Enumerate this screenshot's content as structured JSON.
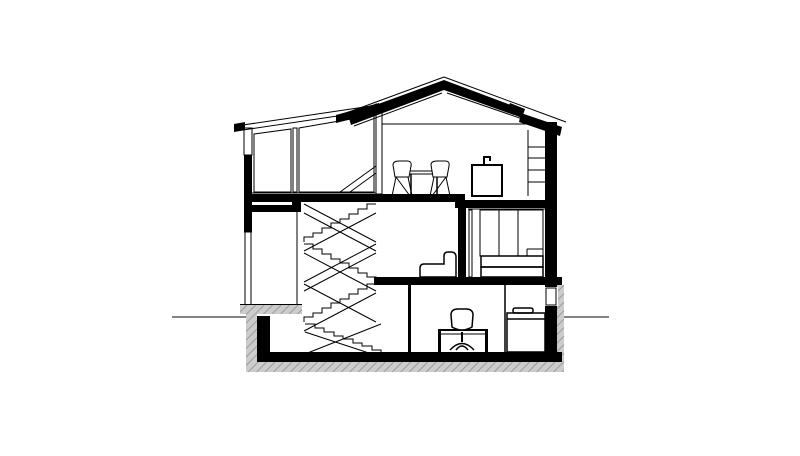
{
  "meta": {
    "width": 800,
    "height": 456,
    "drawing_kind": "architectural cross-section of a three-level gabled house"
  },
  "colors": {
    "background": "#ffffff",
    "ink": "#000000",
    "hatch_fill": "#cccccc",
    "hatch_line": "#8f8f8f",
    "ground_line": "#5a5a5a"
  },
  "drawing": {
    "levels": [
      {
        "name": "attic-floor",
        "contents": [
          "dining-table",
          "two-chairs",
          "kitchen-island-with-faucet",
          "wall-shelves"
        ]
      },
      {
        "name": "middle-floor",
        "contents": [
          "entry-door",
          "staircase",
          "sofa",
          "wardrobe",
          "bed"
        ]
      },
      {
        "name": "basement",
        "contents": [
          "staircase",
          "desk",
          "office-chair",
          "cabinet-washer",
          "light-well-window"
        ]
      }
    ],
    "structure": [
      "gable-roof-with-skylight",
      "shed-roof-over-glazed-living-space",
      "clerestory-post",
      "sectioned-walls-black",
      "floor-slabs-black",
      "insulated-foundation-hatched",
      "ground-line-left",
      "ground-line-right"
    ]
  }
}
